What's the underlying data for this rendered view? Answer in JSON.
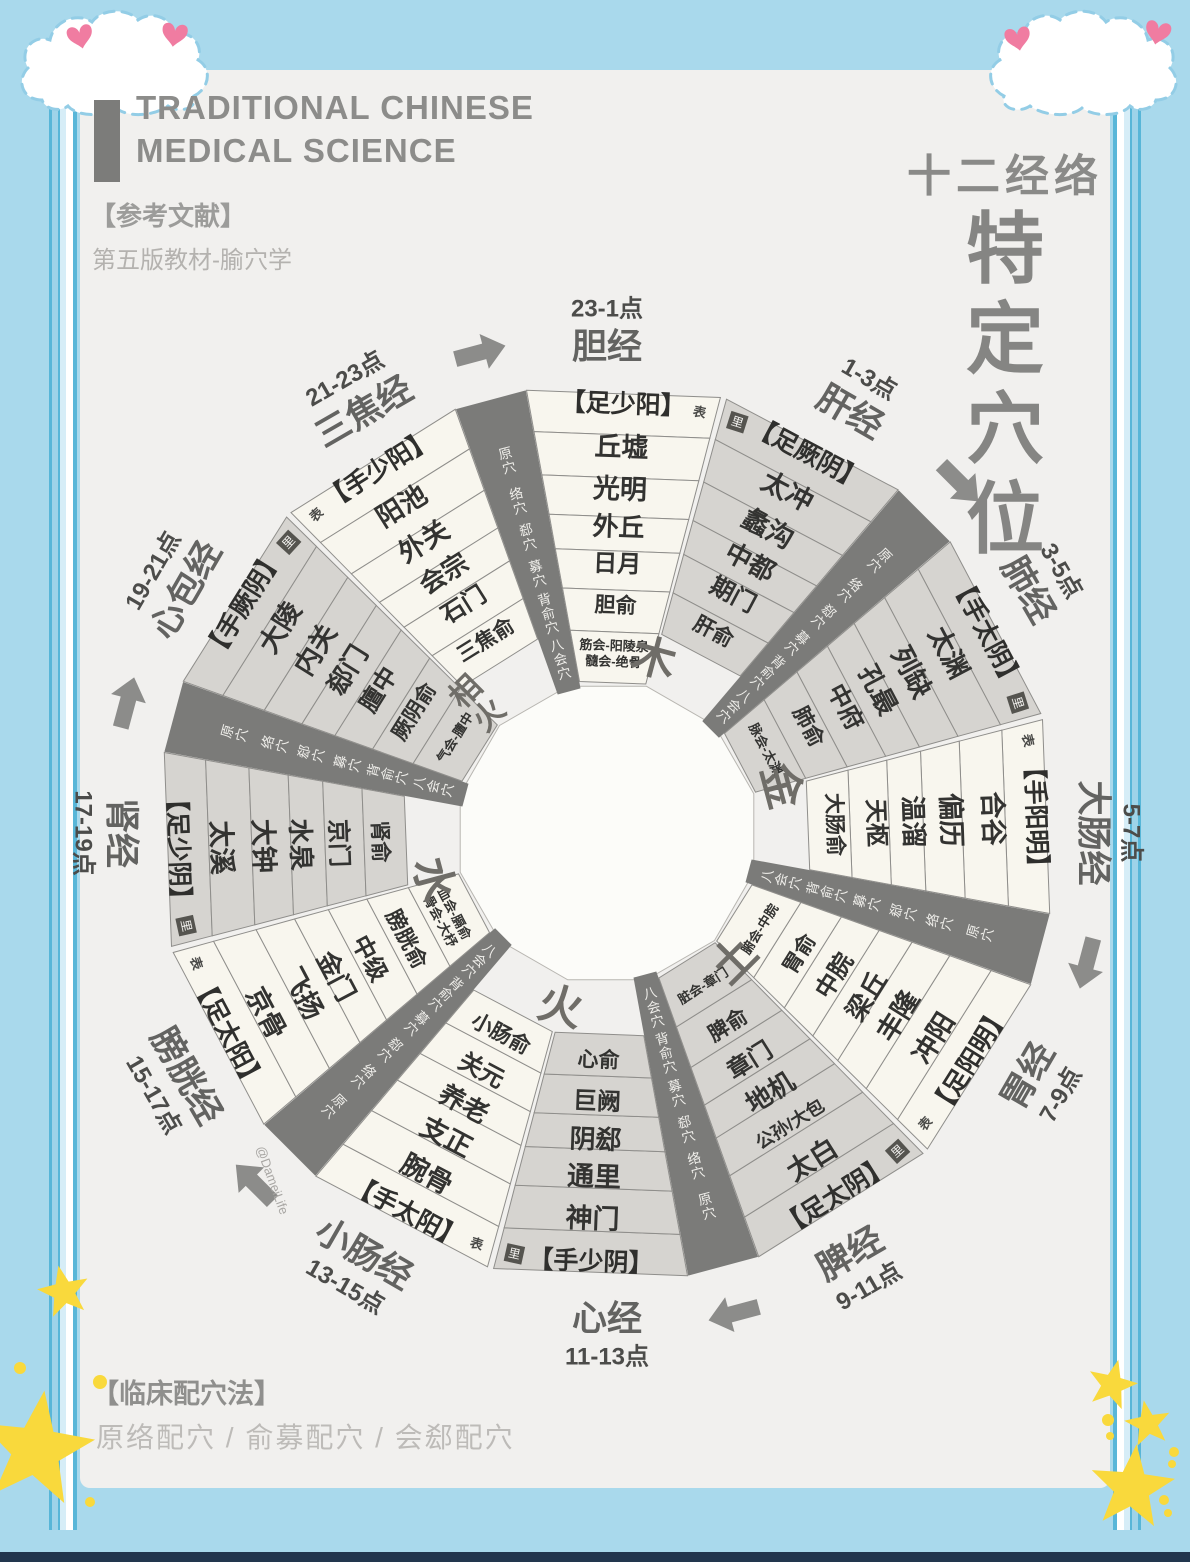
{
  "colors": {
    "background_blue": "#a9d9ec",
    "page_grey": "#f1f0ee",
    "stripe_blue": "#58b6d8",
    "cream_segment": "#f8f6ee",
    "grey_segment": "#d6d4d0",
    "divider_dark": "#7b7b79",
    "title_grey": "#8b8b89",
    "text_dark": "#3b3b39",
    "name_grey": "#66666[4]",
    "star_yellow": "#f9d93c",
    "heart_pink": "#f07ca1",
    "bottom_navy": "#22364e",
    "arrow_grey": "#8c8c8a"
  },
  "header": {
    "title_en_line1": "TRADITIONAL CHINESE",
    "title_en_line2": "MEDICAL SCIENCE",
    "reference_label": "【参考文献】",
    "reference_text": "第五版教材-腧穴学"
  },
  "poster_title": {
    "subtitle": "十二经络",
    "line1": "特定",
    "line2": "穴位"
  },
  "footer": {
    "label": "【临床配穴法】",
    "text": "原络配穴 / 俞募配穴 / 会郄配穴"
  },
  "watermark": "@DameiLife",
  "wheel": {
    "ring_labels": [
      "原穴",
      "络穴",
      "郄穴",
      "募穴",
      "背俞穴",
      "八会穴"
    ],
    "five_elements": [
      "木",
      "金",
      "土",
      "火",
      "水",
      "相火"
    ],
    "meridians": [
      {
        "name": "胆经",
        "time": "23-1点",
        "channel": "【足少阳】",
        "surface": "表",
        "tone": "cream",
        "points": [
          "丘墟",
          "光明",
          "外丘",
          "日月",
          "胆俞"
        ],
        "bahui": [
          "筋会-阳陵泉",
          "髓会-绝骨"
        ]
      },
      {
        "name": "肝经",
        "time": "1-3点",
        "channel": "【足厥阴】",
        "surface": "里",
        "tone": "grey",
        "points": [
          "太冲",
          "蠡沟",
          "中都",
          "期门",
          "肝俞"
        ],
        "bahui": []
      },
      {
        "name": "肺经",
        "time": "3-5点",
        "channel": "【手太阴】",
        "surface": "里",
        "tone": "grey",
        "points": [
          "太渊",
          "列缺",
          "孔最",
          "中府",
          "肺俞"
        ],
        "bahui": [
          "脉会-太渊"
        ]
      },
      {
        "name": "大肠经",
        "time": "5-7点",
        "channel": "【手阳明】",
        "surface": "表",
        "tone": "cream",
        "points": [
          "合谷",
          "偏历",
          "温溜",
          "天枢",
          "大肠俞"
        ],
        "bahui": []
      },
      {
        "name": "胃经",
        "time": "7-9点",
        "channel": "【足阳明】",
        "surface": "表",
        "tone": "cream",
        "points": [
          "冲阳",
          "丰隆",
          "梁丘",
          "中脘",
          "胃俞"
        ],
        "bahui": [
          "腑会-中脘"
        ]
      },
      {
        "name": "脾经",
        "time": "9-11点",
        "channel": "【足太阴】",
        "surface": "里",
        "tone": "grey",
        "points": [
          "太白",
          "公孙/大包",
          "地机",
          "章门",
          "脾俞"
        ],
        "bahui": [
          "脏会-章门"
        ]
      },
      {
        "name": "心经",
        "time": "11-13点",
        "channel": "【手少阴】",
        "surface": "里",
        "tone": "grey",
        "points": [
          "神门",
          "通里",
          "阴郄",
          "巨阙",
          "心俞"
        ],
        "bahui": []
      },
      {
        "name": "小肠经",
        "time": "13-15点",
        "channel": "【手太阳】",
        "surface": "表",
        "tone": "cream",
        "points": [
          "腕骨",
          "支正",
          "养老",
          "关元",
          "小肠俞"
        ],
        "bahui": []
      },
      {
        "name": "膀胱经",
        "time": "15-17点",
        "channel": "【足太阳】",
        "surface": "表",
        "tone": "cream",
        "points": [
          "京骨",
          "飞扬",
          "金门",
          "中级",
          "膀胱俞"
        ],
        "bahui": [
          "血会-膈俞",
          "骨会-大杼"
        ]
      },
      {
        "name": "肾经",
        "time": "17-19点",
        "channel": "【足少阴】",
        "surface": "里",
        "tone": "grey",
        "points": [
          "太溪",
          "大钟",
          "水泉",
          "京门",
          "肾俞"
        ],
        "bahui": []
      },
      {
        "name": "心包经",
        "time": "19-21点",
        "channel": "【手厥阴】",
        "surface": "里",
        "tone": "grey",
        "points": [
          "大陵",
          "内关",
          "郄门",
          "膻中",
          "厥阴俞"
        ],
        "bahui": [
          "气会-膻中"
        ]
      },
      {
        "name": "三焦经",
        "time": "21-23点",
        "channel": "【手少阳】",
        "surface": "表",
        "tone": "cream",
        "points": [
          "阳池",
          "外关",
          "会宗",
          "石门",
          "三焦俞"
        ],
        "bahui": []
      }
    ]
  }
}
